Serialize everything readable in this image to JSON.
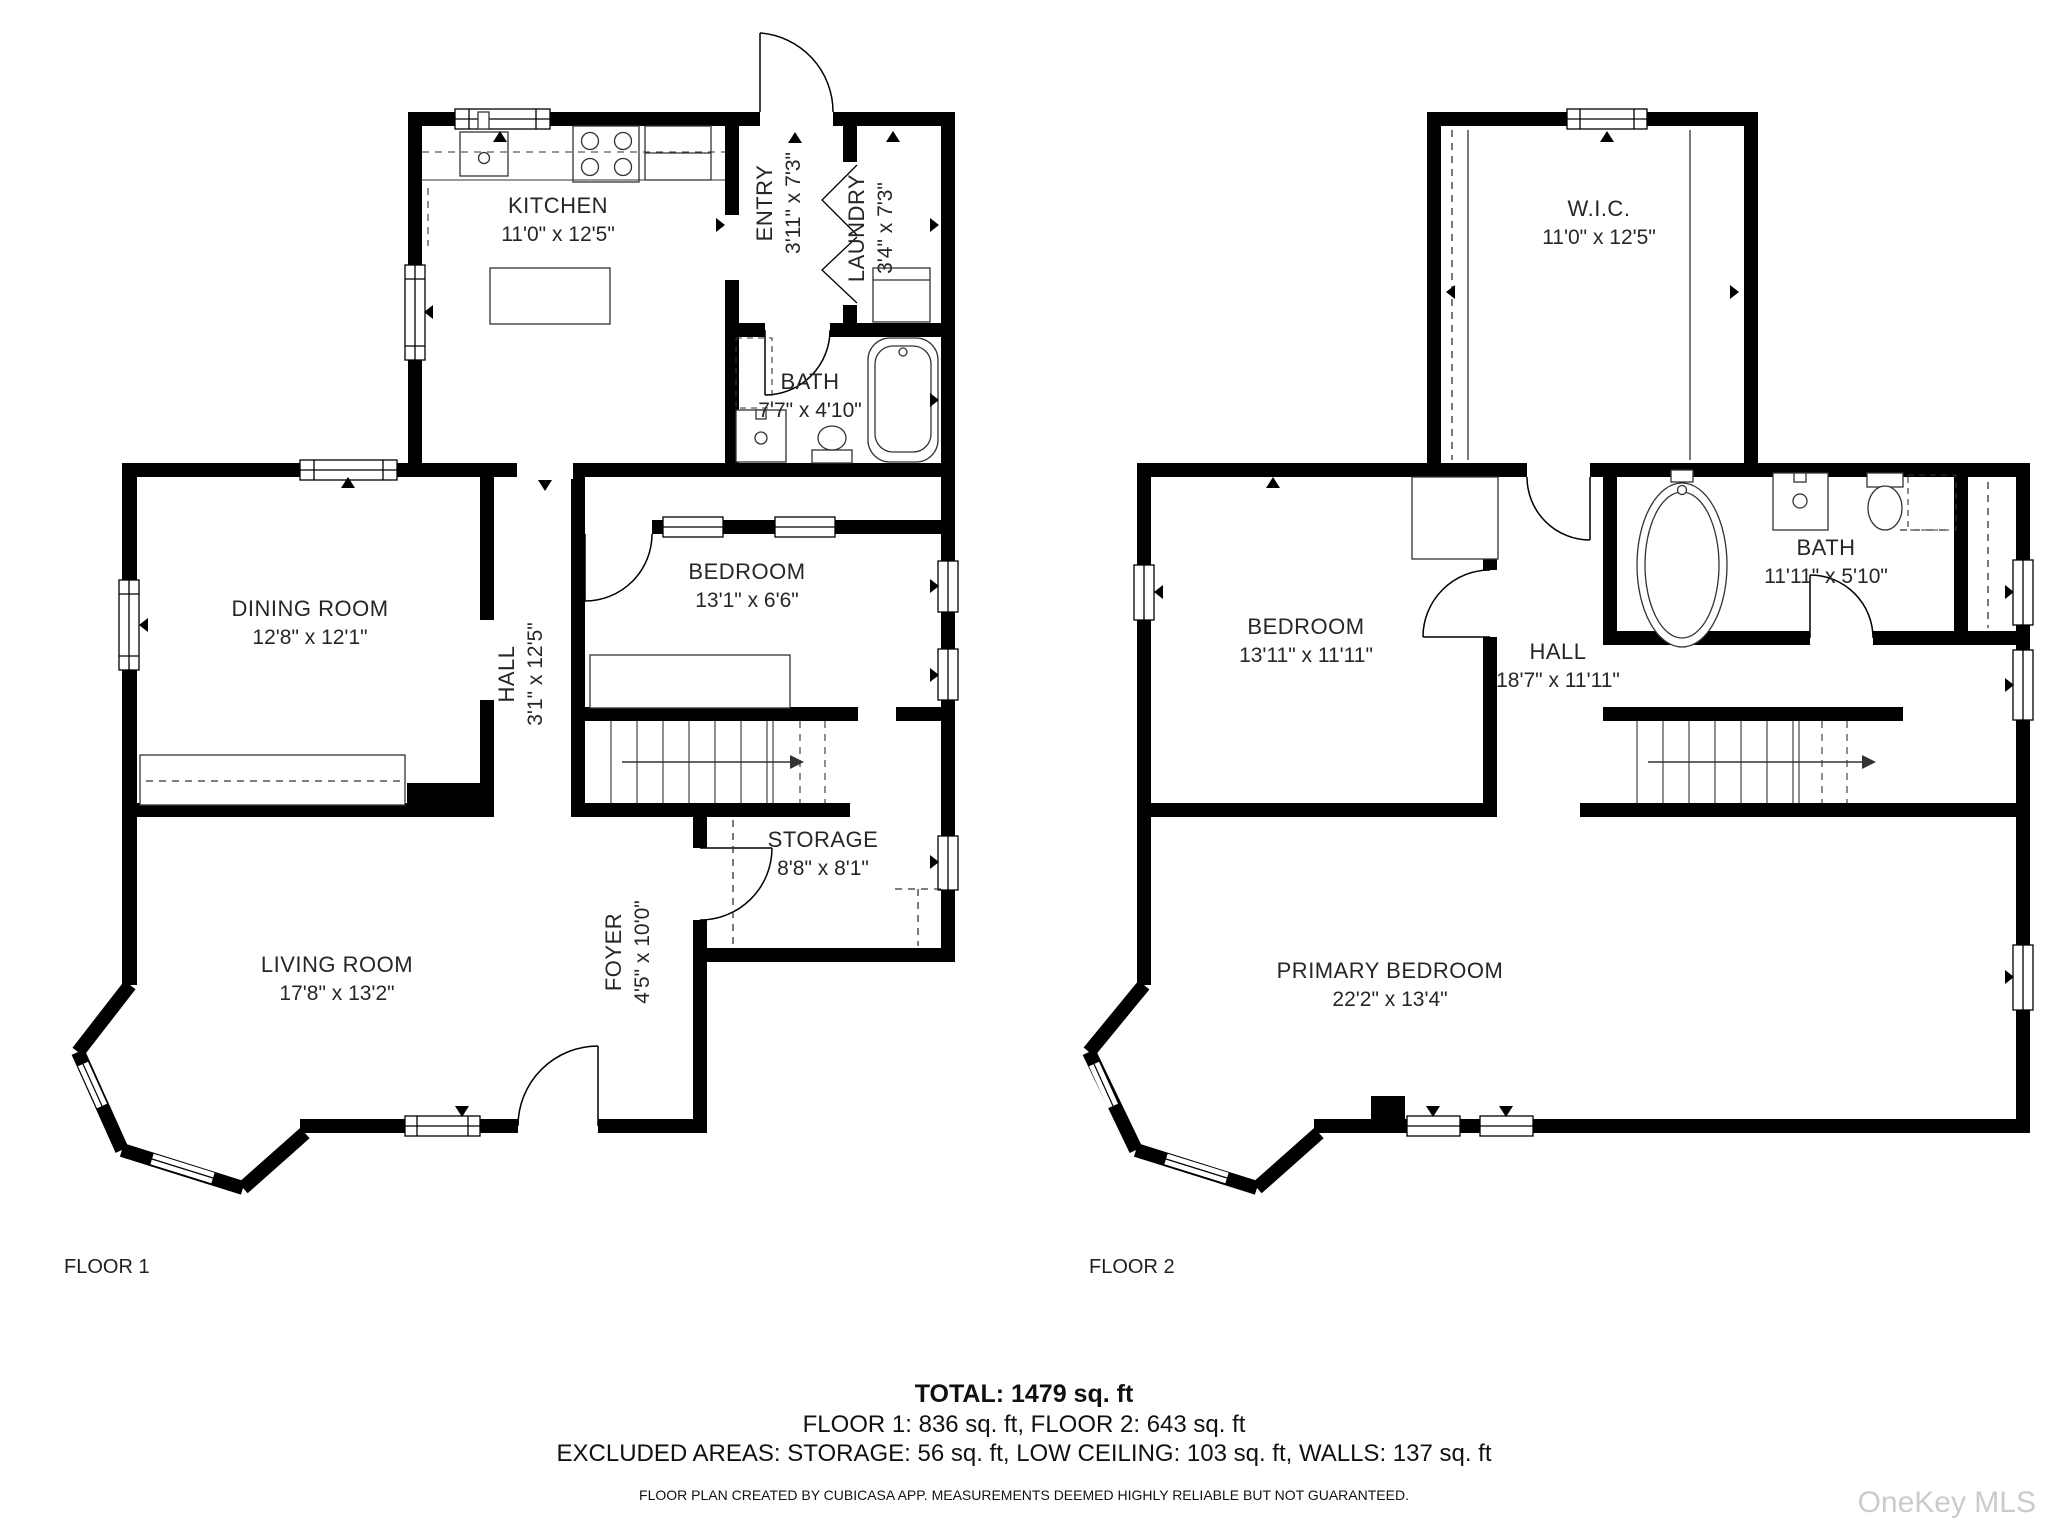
{
  "floor1": {
    "label": "FLOOR 1",
    "rooms": {
      "kitchen": {
        "name": "KITCHEN",
        "dims": "11'0\" x 12'5\""
      },
      "entry": {
        "name": "ENTRY",
        "dims": "3'11\" x 7'3\""
      },
      "laundry": {
        "name": "LAUNDRY",
        "dims": "3'4\" x 7'3\""
      },
      "bath": {
        "name": "BATH",
        "dims": "7'7\" x 4'10\""
      },
      "dining_room": {
        "name": "DINING ROOM",
        "dims": "12'8\" x 12'1\""
      },
      "hall": {
        "name": "HALL",
        "dims": "3'1\" x 12'5\""
      },
      "bedroom": {
        "name": "BEDROOM",
        "dims": "13'1\" x 6'6\""
      },
      "storage": {
        "name": "STORAGE",
        "dims": "8'8\" x 8'1\""
      },
      "foyer": {
        "name": "FOYER",
        "dims": "4'5\" x 10'0\""
      },
      "living_room": {
        "name": "LIVING ROOM",
        "dims": "17'8\" x 13'2\""
      }
    }
  },
  "floor2": {
    "label": "FLOOR 2",
    "rooms": {
      "wic": {
        "name": "W.I.C.",
        "dims": "11'0\" x 12'5\""
      },
      "bedroom": {
        "name": "BEDROOM",
        "dims": "13'11\" x 11'11\""
      },
      "hall": {
        "name": "HALL",
        "dims": "18'7\" x 11'11\""
      },
      "bath": {
        "name": "BATH",
        "dims": "11'11\" x 5'10\""
      },
      "primary_bedroom": {
        "name": "PRIMARY BEDROOM",
        "dims": "22'2\" x 13'4\""
      }
    }
  },
  "summary": {
    "total": "TOTAL: 1479 sq. ft",
    "floors": "FLOOR 1: 836 sq. ft, FLOOR 2: 643 sq. ft",
    "excluded": "EXCLUDED AREAS: STORAGE: 56 sq. ft, LOW CEILING: 103 sq. ft, WALLS: 137 sq. ft",
    "disclaimer": "FLOOR PLAN CREATED BY CUBICASA APP. MEASUREMENTS DEEMED HIGHLY RELIABLE BUT NOT GUARANTEED."
  },
  "watermark": "OneKey MLS"
}
